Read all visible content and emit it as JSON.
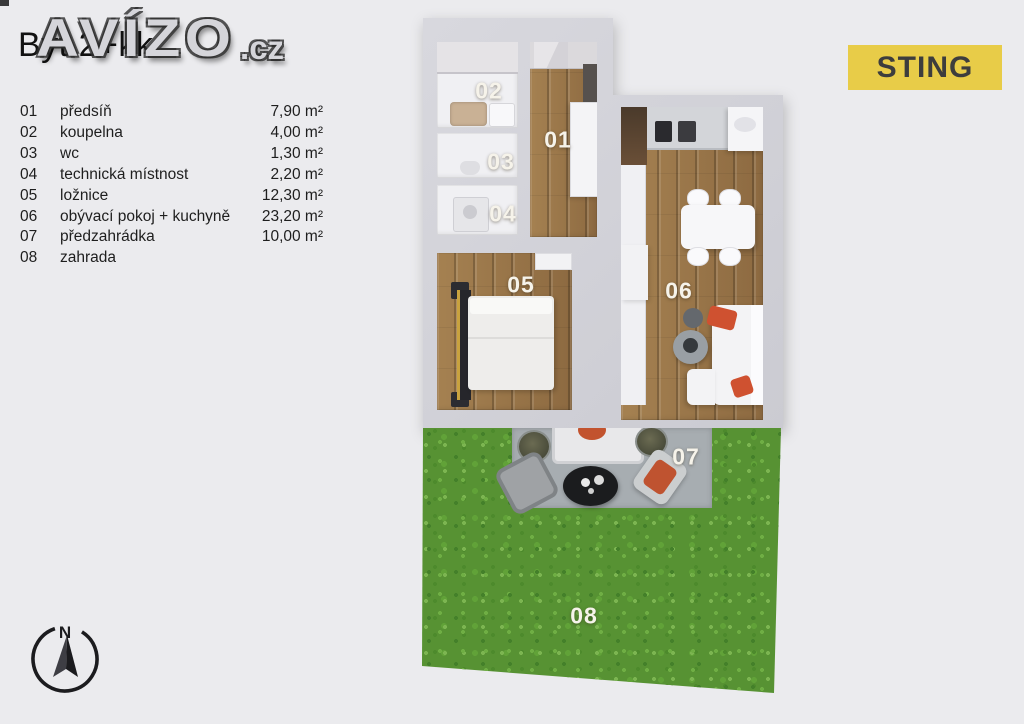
{
  "title": "Byt 2+kk",
  "watermark": {
    "main": "AVÍZO",
    "suffix": ".cz"
  },
  "brand_badge": {
    "label": "STING",
    "background": "#e8cc48",
    "text_color": "#3d3d3d"
  },
  "legend": {
    "items": [
      {
        "num": "01",
        "name": "předsíň",
        "area": "7,90 m²"
      },
      {
        "num": "02",
        "name": "koupelna",
        "area": "4,00 m²"
      },
      {
        "num": "03",
        "name": "wc",
        "area": "1,30 m²"
      },
      {
        "num": "04",
        "name": "technická místnost",
        "area": "2,20 m²"
      },
      {
        "num": "05",
        "name": "ložnice",
        "area": "12,30 m²"
      },
      {
        "num": "06",
        "name": "obývací pokoj + kuchyně",
        "area": "23,20 m²"
      },
      {
        "num": "07",
        "name": "předzahrádka",
        "area": "10,00 m²"
      },
      {
        "num": "08",
        "name": "zahrada",
        "area": ""
      }
    ]
  },
  "floorplan": {
    "labels": {
      "r01": "01",
      "r02": "02",
      "r03": "03",
      "r04": "04",
      "r05": "05",
      "r06": "06",
      "r07": "07",
      "r08": "08"
    },
    "colors": {
      "wall": "#d2d2d8",
      "room": "#f0f0f3",
      "wood": "#9a774b",
      "grass": "#579233",
      "patio": "#a7adb1",
      "pillow_accent": "#cf5130"
    }
  },
  "compass": {
    "label": "N"
  }
}
